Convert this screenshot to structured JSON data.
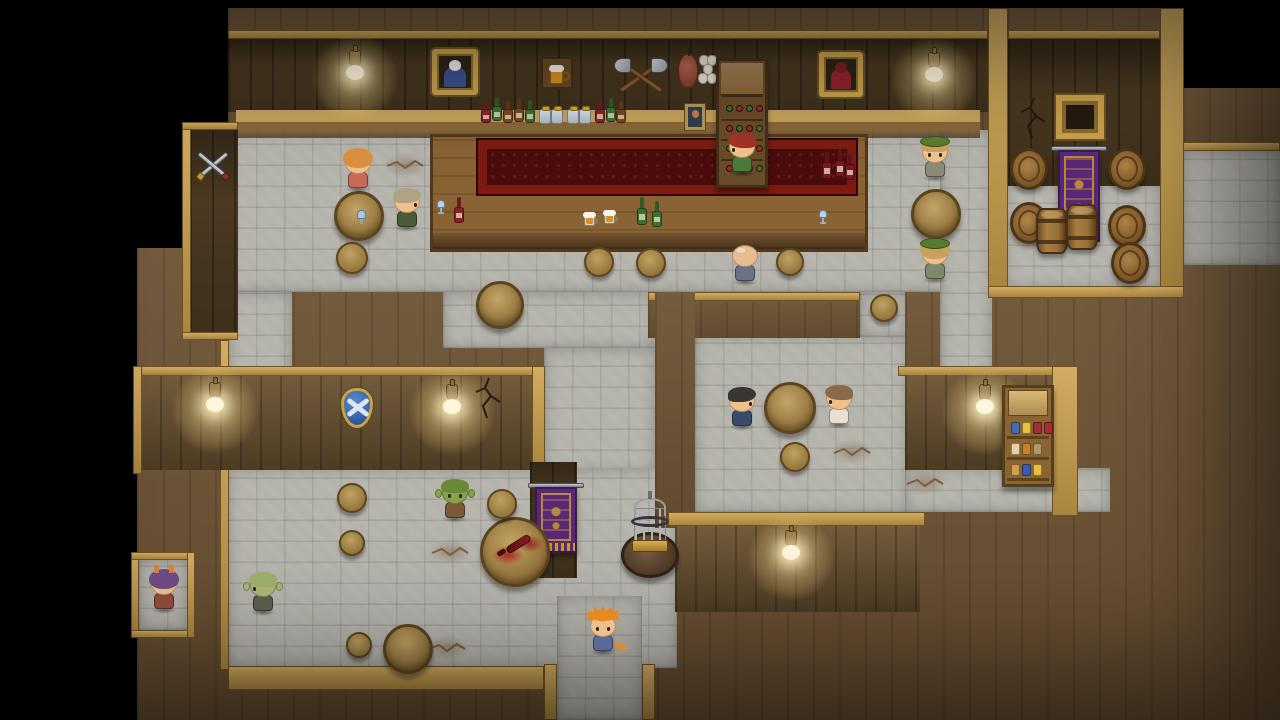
{
  "scene": {
    "name": "tavern-interior-rpg-map",
    "width": 1280,
    "height": 720
  },
  "palette": {
    "black": "#000000",
    "wood_top": "#6e5334",
    "wall_dark": "#4b3a22",
    "wall_mid": "#6b5230",
    "stone_floor": "#b5b4ac",
    "trim_gold": "#c9a24a",
    "counter_wood": "#8a6335",
    "carpet_red": "#4a0c0c",
    "carpet_border": "#7c1c10",
    "banner_purple": "#5a2878",
    "banner_gold": "#c89a30",
    "lamp_glow": "#ffecaa",
    "table_wood": "#a88c50"
  },
  "regions": [
    {
      "name": "wall-top-lower-mass",
      "kind": "wood",
      "x": 137,
      "y": 248,
      "w": 1143,
      "h": 472
    },
    {
      "name": "wall-top-upper-band",
      "kind": "wood",
      "x": 228,
      "y": 8,
      "w": 955,
      "h": 130
    },
    {
      "name": "wall-top-right-upper",
      "kind": "wood",
      "x": 1183,
      "y": 88,
      "w": 97,
      "h": 62
    },
    {
      "name": "floor-main-hall",
      "kind": "stone",
      "x": 228,
      "y": 130,
      "w": 760,
      "h": 162
    },
    {
      "name": "floor-storage-room",
      "kind": "stone",
      "x": 1005,
      "y": 183,
      "w": 157,
      "h": 105
    },
    {
      "name": "floor-east-passage",
      "kind": "stone",
      "x": 1183,
      "y": 150,
      "w": 97,
      "h": 115
    },
    {
      "name": "floor-west-corridor",
      "kind": "stone",
      "x": 228,
      "y": 292,
      "w": 64,
      "h": 380
    },
    {
      "name": "floor-mid-corridor",
      "kind": "stone",
      "x": 443,
      "y": 292,
      "w": 212,
      "h": 56
    },
    {
      "name": "floor-mid-connector",
      "kind": "stone",
      "x": 544,
      "y": 348,
      "w": 111,
      "h": 124
    },
    {
      "name": "floor-southwest-room",
      "kind": "stone",
      "x": 228,
      "y": 468,
      "w": 449,
      "h": 200
    },
    {
      "name": "floor-south-corridor",
      "kind": "stone",
      "x": 557,
      "y": 596,
      "w": 85,
      "h": 124
    },
    {
      "name": "floor-southeast-room",
      "kind": "stone",
      "x": 695,
      "y": 335,
      "w": 213,
      "h": 177
    },
    {
      "name": "floor-southeast-entry",
      "kind": "stone",
      "x": 860,
      "y": 292,
      "w": 48,
      "h": 45
    },
    {
      "name": "floor-right-corridor",
      "kind": "stone",
      "x": 940,
      "y": 130,
      "w": 52,
      "h": 248
    },
    {
      "name": "floor-pantry-strip",
      "kind": "stone",
      "x": 905,
      "y": 468,
      "w": 205,
      "h": 44
    },
    {
      "name": "floor-alcove",
      "kind": "stone",
      "x": 139,
      "y": 560,
      "w": 48,
      "h": 70
    },
    {
      "name": "wall-bar-back",
      "kind": "walldark",
      "x": 228,
      "y": 38,
      "w": 760,
      "h": 74
    },
    {
      "name": "trim-bar-top",
      "kind": "trim",
      "x": 228,
      "y": 30,
      "w": 760,
      "h": 9
    },
    {
      "name": "shelf-ledge-long",
      "kind": "ledge",
      "x": 236,
      "y": 110,
      "w": 744,
      "h": 28
    },
    {
      "name": "wall-storage-back",
      "kind": "walldark",
      "x": 1008,
      "y": 38,
      "w": 152,
      "h": 148
    },
    {
      "name": "trim-storage-left-col",
      "kind": "trim",
      "x": 988,
      "y": 8,
      "w": 20,
      "h": 284
    },
    {
      "name": "trim-storage-right-col",
      "kind": "trim",
      "x": 1160,
      "y": 8,
      "w": 24,
      "h": 284
    },
    {
      "name": "trim-storage-top",
      "kind": "trim",
      "x": 1008,
      "y": 30,
      "w": 152,
      "h": 9
    },
    {
      "name": "trim-storage-bottom",
      "kind": "trim",
      "x": 988,
      "y": 286,
      "w": 196,
      "h": 12
    },
    {
      "name": "trim-east-passage-top",
      "kind": "trim",
      "x": 1183,
      "y": 142,
      "w": 97,
      "h": 9
    },
    {
      "name": "wall-swords-panel",
      "kind": "walldark",
      "x": 190,
      "y": 130,
      "w": 48,
      "h": 202
    },
    {
      "name": "trim-swords-left",
      "kind": "trim",
      "x": 182,
      "y": 122,
      "w": 9,
      "h": 218
    },
    {
      "name": "trim-swords-top",
      "kind": "trim",
      "x": 182,
      "y": 122,
      "w": 56,
      "h": 8
    },
    {
      "name": "trim-swords-bottom",
      "kind": "trim",
      "x": 182,
      "y": 332,
      "w": 56,
      "h": 8
    },
    {
      "name": "trim-west-edge",
      "kind": "trim",
      "x": 220,
      "y": 340,
      "w": 9,
      "h": 330
    },
    {
      "name": "wall-shield-panel",
      "kind": "wallmid",
      "x": 140,
      "y": 375,
      "w": 392,
      "h": 95
    },
    {
      "name": "trim-shield-panel-top",
      "kind": "trim",
      "x": 133,
      "y": 366,
      "w": 406,
      "h": 10
    },
    {
      "name": "trim-shield-panel-left",
      "kind": "trim",
      "x": 133,
      "y": 366,
      "w": 9,
      "h": 108
    },
    {
      "name": "trim-shield-panel-right",
      "kind": "trim",
      "x": 532,
      "y": 366,
      "w": 13,
      "h": 106
    },
    {
      "name": "wall-banner-mid",
      "kind": "walldark",
      "x": 530,
      "y": 462,
      "w": 47,
      "h": 116
    },
    {
      "name": "wall-se-room-top",
      "kind": "wood",
      "x": 648,
      "y": 292,
      "w": 212,
      "h": 46
    },
    {
      "name": "trim-se-room-top",
      "kind": "trim",
      "x": 648,
      "y": 292,
      "w": 212,
      "h": 9
    },
    {
      "name": "wall-se-room-left-col",
      "kind": "wood",
      "x": 655,
      "y": 292,
      "w": 40,
      "h": 236
    },
    {
      "name": "wall-se-room-right-col",
      "kind": "wood",
      "x": 905,
      "y": 292,
      "w": 35,
      "h": 176
    },
    {
      "name": "trim-south-wall-top",
      "kind": "trim",
      "x": 668,
      "y": 512,
      "w": 257,
      "h": 14
    },
    {
      "name": "wall-south-lamp",
      "kind": "wallmid",
      "x": 675,
      "y": 526,
      "w": 245,
      "h": 86
    },
    {
      "name": "trim-pantry-top",
      "kind": "trim",
      "x": 898,
      "y": 366,
      "w": 180,
      "h": 10
    },
    {
      "name": "wall-pantry",
      "kind": "wallmid",
      "x": 905,
      "y": 375,
      "w": 147,
      "h": 95
    },
    {
      "name": "trim-pantry-right-col",
      "kind": "trim",
      "x": 1052,
      "y": 366,
      "w": 26,
      "h": 150
    },
    {
      "name": "trim-south-corridor-left",
      "kind": "trim",
      "x": 544,
      "y": 664,
      "w": 13,
      "h": 56
    },
    {
      "name": "trim-south-corridor-right",
      "kind": "trim",
      "x": 642,
      "y": 664,
      "w": 13,
      "h": 56
    },
    {
      "name": "trim-southwest-band",
      "kind": "trim",
      "x": 228,
      "y": 666,
      "w": 316,
      "h": 24
    },
    {
      "name": "trim-alcove-left",
      "kind": "trim",
      "x": 131,
      "y": 552,
      "w": 8,
      "h": 86
    },
    {
      "name": "trim-alcove-top",
      "kind": "trim",
      "x": 131,
      "y": 552,
      "w": 64,
      "h": 8
    },
    {
      "name": "trim-alcove-bottom",
      "kind": "trim",
      "x": 131,
      "y": 630,
      "w": 64,
      "h": 8
    },
    {
      "name": "trim-alcove-right",
      "kind": "trim",
      "x": 187,
      "y": 552,
      "w": 8,
      "h": 86
    },
    {
      "name": "bar-counter",
      "kind": "counter",
      "x": 430,
      "y": 134,
      "w": 438,
      "h": 118
    },
    {
      "name": "bar-carpet",
      "kind": "carpet",
      "x": 478,
      "y": 140,
      "w": 378,
      "h": 54
    }
  ],
  "props": [
    {
      "name": "wall-lamp-1",
      "kind": "lamp",
      "x": 355,
      "y": 66
    },
    {
      "name": "wall-lamp-2",
      "kind": "lamp",
      "x": 934,
      "y": 68
    },
    {
      "name": "wall-lamp-3",
      "kind": "lamp",
      "x": 215,
      "y": 398
    },
    {
      "name": "wall-lamp-4",
      "kind": "lamp",
      "x": 452,
      "y": 400
    },
    {
      "name": "wall-lamp-5",
      "kind": "lamp",
      "x": 985,
      "y": 400
    },
    {
      "name": "wall-lamp-6",
      "kind": "lamp",
      "x": 791,
      "y": 546
    },
    {
      "name": "painting-sage",
      "kind": "painting",
      "x": 455,
      "y": 72,
      "w": 46,
      "h": 46,
      "robe": "#3f518f",
      "hairc": "#e8e8e8"
    },
    {
      "name": "painting-witch",
      "kind": "painting",
      "x": 841,
      "y": 74,
      "w": 44,
      "h": 45,
      "robe": "#97232d",
      "hairc": "#7a1f28"
    },
    {
      "name": "beer-sign",
      "kind": "beersign",
      "x": 557,
      "y": 73
    },
    {
      "name": "crossed-axes",
      "kind": "axes",
      "x": 641,
      "y": 77
    },
    {
      "name": "hanging-ham",
      "kind": "ham",
      "x": 688,
      "y": 71
    },
    {
      "name": "hanging-garlic",
      "kind": "garlic",
      "x": 708,
      "y": 70
    },
    {
      "name": "wine-rack",
      "kind": "winerack",
      "x": 742,
      "y": 123
    },
    {
      "name": "shelf-bottle-1",
      "kind": "bottle",
      "x": 486,
      "y": 112,
      "c": "#8a2430",
      "h": 22
    },
    {
      "name": "shelf-bottle-2",
      "kind": "bottle",
      "x": 497,
      "y": 109,
      "c": "#3f6f2f",
      "h": 24
    },
    {
      "name": "shelf-bottle-3",
      "kind": "bottle",
      "x": 508,
      "y": 112,
      "c": "#7a4a22",
      "h": 22
    },
    {
      "name": "shelf-bottle-4",
      "kind": "bottle",
      "x": 519,
      "y": 110,
      "c": "#7a4a22",
      "h": 23
    },
    {
      "name": "shelf-bottle-5",
      "kind": "bottle",
      "x": 530,
      "y": 111,
      "c": "#3f6f2f",
      "h": 23
    },
    {
      "name": "shelf-jar-1",
      "kind": "jar",
      "x": 545,
      "y": 116
    },
    {
      "name": "shelf-jar-2",
      "kind": "jar",
      "x": 557,
      "y": 116
    },
    {
      "name": "shelf-jar-3",
      "kind": "jar",
      "x": 573,
      "y": 116
    },
    {
      "name": "shelf-jar-4",
      "kind": "jar",
      "x": 585,
      "y": 116
    },
    {
      "name": "shelf-bottle-6",
      "kind": "bottle",
      "x": 600,
      "y": 111,
      "c": "#8a2430",
      "h": 23
    },
    {
      "name": "shelf-bottle-7",
      "kind": "bottle",
      "x": 611,
      "y": 110,
      "c": "#3f6f2f",
      "h": 24
    },
    {
      "name": "shelf-bottle-8",
      "kind": "bottle",
      "x": 621,
      "y": 112,
      "c": "#7a4a22",
      "h": 22
    },
    {
      "name": "shelf-picture",
      "kind": "smallpic",
      "x": 695,
      "y": 117
    },
    {
      "name": "crossed-swords",
      "kind": "swords",
      "x": 213,
      "y": 167
    },
    {
      "name": "wall-shield",
      "kind": "shield",
      "x": 357,
      "y": 408
    },
    {
      "name": "wall-crack-shield-panel",
      "kind": "crackwall",
      "x": 489,
      "y": 398
    },
    {
      "name": "wall-crack-storage",
      "kind": "crackwall",
      "x": 1034,
      "y": 118
    },
    {
      "name": "storage-window",
      "kind": "window",
      "x": 1080,
      "y": 117
    },
    {
      "name": "banner-storage",
      "kind": "banner",
      "x": 1079,
      "y": 196,
      "w": 42,
      "h": 92
    },
    {
      "name": "banner-mid",
      "kind": "banner",
      "x": 556,
      "y": 520,
      "w": 42,
      "h": 66
    },
    {
      "name": "barrel-side-1",
      "kind": "barrelside",
      "x": 1029,
      "y": 169
    },
    {
      "name": "barrel-side-2",
      "kind": "barrelside",
      "x": 1127,
      "y": 169
    },
    {
      "name": "barrel-side-3",
      "kind": "barrelside",
      "x": 1029,
      "y": 223
    },
    {
      "name": "barrel-side-4",
      "kind": "barrelside",
      "x": 1127,
      "y": 226
    },
    {
      "name": "barrel-side-5",
      "kind": "barrelside",
      "x": 1130,
      "y": 263
    },
    {
      "name": "barrel-upright-1",
      "kind": "barrelup",
      "x": 1052,
      "y": 231
    },
    {
      "name": "barrel-upright-2",
      "kind": "barrelup",
      "x": 1082,
      "y": 227
    },
    {
      "name": "goods-shelf",
      "kind": "goodsshelf",
      "x": 1028,
      "y": 436
    },
    {
      "name": "birdcage-table",
      "kind": "cagetable",
      "x": 650,
      "y": 545
    },
    {
      "name": "spilled-wine-table",
      "kind": "spilltable",
      "x": 515,
      "y": 552
    },
    {
      "name": "table-1",
      "kind": "table",
      "x": 359,
      "y": 216,
      "r": 25,
      "glass": true
    },
    {
      "name": "table-2",
      "kind": "table",
      "x": 936,
      "y": 214,
      "r": 25
    },
    {
      "name": "table-3",
      "kind": "table",
      "x": 500,
      "y": 305,
      "r": 24
    },
    {
      "name": "table-4",
      "kind": "table",
      "x": 790,
      "y": 408,
      "r": 26
    },
    {
      "name": "table-5",
      "kind": "table",
      "x": 408,
      "y": 649,
      "r": 25
    },
    {
      "name": "stool-1",
      "kind": "stool",
      "x": 352,
      "y": 258,
      "r": 16
    },
    {
      "name": "stool-2",
      "kind": "stool",
      "x": 599,
      "y": 262,
      "r": 15
    },
    {
      "name": "stool-3",
      "kind": "stool",
      "x": 651,
      "y": 263,
      "r": 15
    },
    {
      "name": "stool-4",
      "kind": "stool",
      "x": 790,
      "y": 262,
      "r": 14
    },
    {
      "name": "stool-5",
      "kind": "stool",
      "x": 884,
      "y": 308,
      "r": 14
    },
    {
      "name": "stool-6",
      "kind": "stool",
      "x": 795,
      "y": 457,
      "r": 15
    },
    {
      "name": "stool-7",
      "kind": "stool",
      "x": 352,
      "y": 498,
      "r": 15
    },
    {
      "name": "stool-8",
      "kind": "stool",
      "x": 352,
      "y": 543,
      "r": 13
    },
    {
      "name": "stool-9",
      "kind": "stool",
      "x": 502,
      "y": 504,
      "r": 15
    },
    {
      "name": "stool-10",
      "kind": "stool",
      "x": 359,
      "y": 645,
      "r": 13
    },
    {
      "name": "bar-glass-1",
      "kind": "glass",
      "x": 441,
      "y": 207
    },
    {
      "name": "bar-bottle-red-1",
      "kind": "bottle",
      "x": 459,
      "y": 210,
      "c": "#8a2028",
      "h": 26
    },
    {
      "name": "bar-mug-1",
      "kind": "mug",
      "x": 591,
      "y": 219
    },
    {
      "name": "bar-mug-2",
      "kind": "mug",
      "x": 611,
      "y": 217
    },
    {
      "name": "bar-bottle-green-1",
      "kind": "bottle",
      "x": 642,
      "y": 211,
      "c": "#3f6f2f",
      "h": 28
    },
    {
      "name": "bar-bottle-green-2",
      "kind": "bottle",
      "x": 657,
      "y": 214,
      "c": "#3f6f2f",
      "h": 26
    },
    {
      "name": "bar-bottle-red-2",
      "kind": "bottle",
      "x": 827,
      "y": 165,
      "c": "#7a1822",
      "h": 28
    },
    {
      "name": "bar-bottle-red-3",
      "kind": "bottle",
      "x": 840,
      "y": 163,
      "c": "#7a1822",
      "h": 28
    },
    {
      "name": "bar-bottle-red-4",
      "kind": "bottle",
      "x": 850,
      "y": 167,
      "c": "#7a1822",
      "h": 26
    },
    {
      "name": "bar-glass-2",
      "kind": "glass",
      "x": 823,
      "y": 217
    },
    {
      "name": "floor-crack-1",
      "kind": "crackfloor",
      "x": 405,
      "y": 165
    },
    {
      "name": "floor-crack-2",
      "kind": "crackfloor",
      "x": 852,
      "y": 452
    },
    {
      "name": "floor-crack-3",
      "kind": "crackfloor",
      "x": 450,
      "y": 552
    },
    {
      "name": "floor-crack-4",
      "kind": "crackfloor",
      "x": 447,
      "y": 648
    },
    {
      "name": "floor-crack-5",
      "kind": "crackfloor",
      "x": 925,
      "y": 483
    }
  ],
  "characters": [
    {
      "name": "patron-blonde",
      "x": 358,
      "y": 147,
      "facing": "down-bowed",
      "hair": "#d89040",
      "outfit": "#c86a5a",
      "skin": "#f0c08a"
    },
    {
      "name": "patron-graymane",
      "x": 407,
      "y": 186,
      "facing": "right",
      "hair": "#b0a284",
      "outfit": "#4a5a3a",
      "skin": "#f0c08a"
    },
    {
      "name": "barmaid",
      "x": 742,
      "y": 131,
      "facing": "left",
      "hair": "#a03028",
      "outfit": "#4a7a3a",
      "skin": "#f0c08a"
    },
    {
      "name": "patron-bald",
      "x": 745,
      "y": 240,
      "facing": "up",
      "bald": true,
      "outfit": "#6a7288",
      "skin": "#e8bc8c"
    },
    {
      "name": "soldier-north",
      "x": 935,
      "y": 136,
      "facing": "down",
      "hair": "#c8a060",
      "outfit": "#8a8a7a",
      "cap": "#5a7a30",
      "skin": "#f0c08a"
    },
    {
      "name": "soldier-south",
      "x": 935,
      "y": 238,
      "facing": "up",
      "hair": "#c8a060",
      "outfit": "#7a8a6a",
      "cap": "#5a7a30",
      "skin": "#f0c08a"
    },
    {
      "name": "patron-darkhair",
      "x": 742,
      "y": 385,
      "facing": "right",
      "hair": "#3a3632",
      "outfit": "#3a4a6a",
      "skin": "#f0c08a"
    },
    {
      "name": "patron-brownhair",
      "x": 839,
      "y": 383,
      "facing": "left",
      "hair": "#8a6a4a",
      "outfit": "#e8e0d0",
      "skin": "#f0c08a"
    },
    {
      "name": "goblin-dark",
      "x": 455,
      "y": 477,
      "facing": "down",
      "variant": "goblin",
      "hair": "#6a8a3a",
      "outfit": "#7a5a3a",
      "skin": "#8aa04a"
    },
    {
      "name": "goblin-pale",
      "x": 263,
      "y": 570,
      "facing": "left",
      "variant": "goblin",
      "hair": "#9aab6a",
      "outfit": "#5a5a4a",
      "skin": "#a8b074"
    },
    {
      "name": "imp-purple",
      "x": 164,
      "y": 568,
      "facing": "down-bowed",
      "hair": "#6a4a80",
      "outfit": "#8a4a3a",
      "skin": "#e8bc8c",
      "horns": "#d88030"
    },
    {
      "name": "hero",
      "x": 603,
      "y": 610,
      "facing": "down",
      "variant": "hero",
      "hair": "#e88820",
      "outfit": "#5a6a9a",
      "skin": "#f0c08a"
    }
  ]
}
